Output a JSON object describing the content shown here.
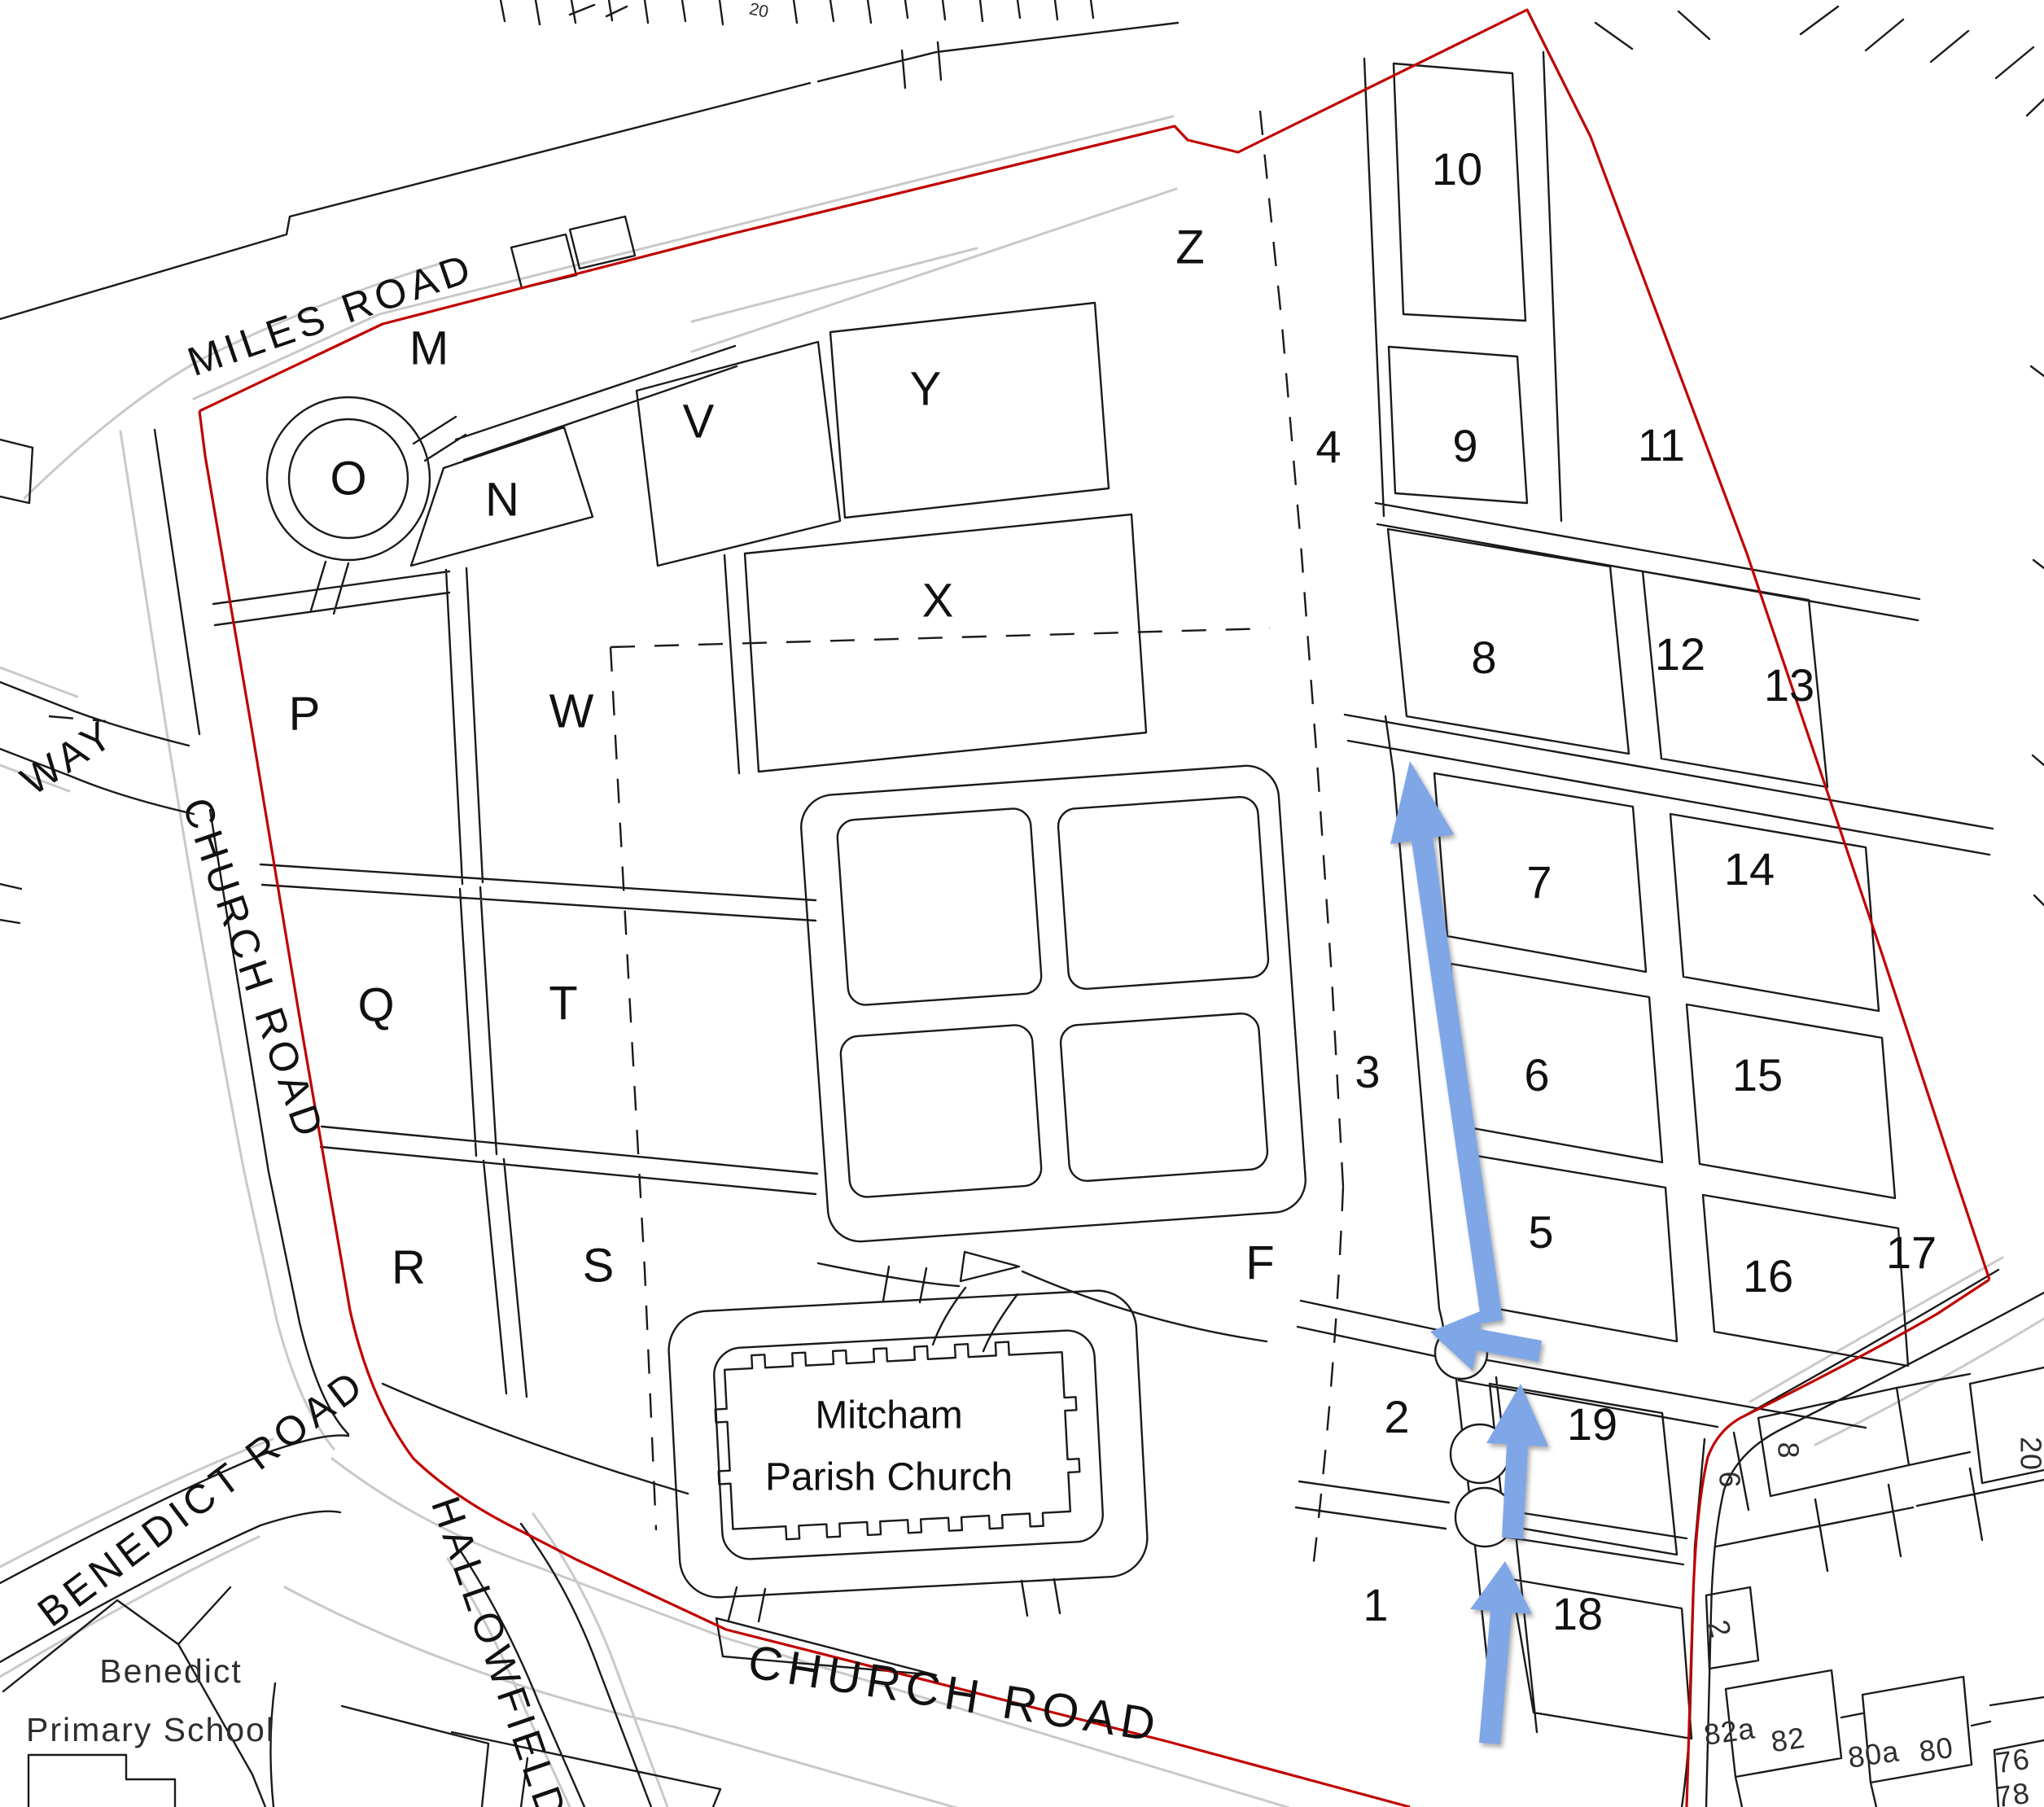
{
  "map": {
    "background": "#ffffff",
    "colors": {
      "linework": "#1a1a1a",
      "road_casing": "#c9c9c9",
      "site_boundary_red": "#c00000",
      "route_arrow_blue": "#7fa7e8"
    },
    "section_letters": [
      {
        "label": "M"
      },
      {
        "label": "O"
      },
      {
        "label": "N"
      },
      {
        "label": "V"
      },
      {
        "label": "Y"
      },
      {
        "label": "X"
      },
      {
        "label": "Z"
      },
      {
        "label": "P"
      },
      {
        "label": "W"
      },
      {
        "label": "Q"
      },
      {
        "label": "T"
      },
      {
        "label": "R"
      },
      {
        "label": "S"
      },
      {
        "label": "F"
      }
    ],
    "section_numbers": [
      {
        "label": "1"
      },
      {
        "label": "2"
      },
      {
        "label": "3"
      },
      {
        "label": "4"
      },
      {
        "label": "5"
      },
      {
        "label": "6"
      },
      {
        "label": "7"
      },
      {
        "label": "8"
      },
      {
        "label": "9"
      },
      {
        "label": "10"
      },
      {
        "label": "11"
      },
      {
        "label": "12"
      },
      {
        "label": "13"
      },
      {
        "label": "14"
      },
      {
        "label": "15"
      },
      {
        "label": "16"
      },
      {
        "label": "17"
      },
      {
        "label": "18"
      },
      {
        "label": "19"
      }
    ],
    "road_labels": [
      {
        "label": "MILES ROAD"
      },
      {
        "label": "WAY"
      },
      {
        "label": "CHURCH ROAD"
      },
      {
        "label": "BENEDICT ROAD"
      },
      {
        "label": "HALLOWFIELD"
      },
      {
        "label": "CHURCH ROAD"
      }
    ],
    "place_labels": [
      {
        "label": "Mitcham"
      },
      {
        "label": "Parish Church"
      },
      {
        "label": "Benedict"
      },
      {
        "label": "Primary School"
      }
    ],
    "house_numbers": [
      {
        "label": "8"
      },
      {
        "label": "6"
      },
      {
        "label": "2"
      },
      {
        "label": "20"
      },
      {
        "label": "82a"
      },
      {
        "label": "82"
      },
      {
        "label": "80a"
      },
      {
        "label": "80"
      },
      {
        "label": "76"
      },
      {
        "label": "78"
      },
      {
        "label": "20"
      }
    ],
    "route_arrows": [
      {
        "name": "route-arrow-long-north"
      },
      {
        "name": "route-arrow-west"
      },
      {
        "name": "route-arrow-middle-north"
      },
      {
        "name": "route-arrow-south-north"
      }
    ]
  }
}
